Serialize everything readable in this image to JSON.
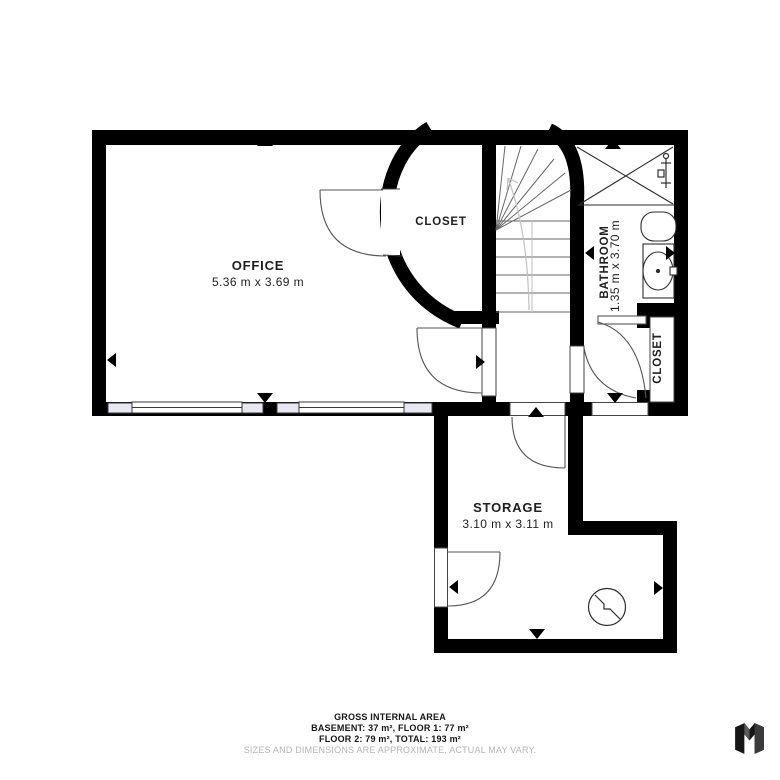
{
  "rooms": {
    "office": {
      "name": "OFFICE",
      "dims": "5.36 m x 3.69 m"
    },
    "closet_top": {
      "name": "CLOSET"
    },
    "bathroom": {
      "name": "BATHROOM",
      "dims": "1.35 m x 3.70 m"
    },
    "closet_right": {
      "name": "CLOSET"
    },
    "storage": {
      "name": "STORAGE",
      "dims": "3.10 m x 3.11 m"
    }
  },
  "footer": {
    "title": "GROSS INTERNAL AREA",
    "areas_line1": "BASEMENT: 37 m², FLOOR 1: 77 m²",
    "areas_line2": "FLOOR 2: 79 m², TOTAL: 193 m²",
    "disclaimer": "SIZES AND DIMENSIONS ARE APPROXIMATE, ACTUAL MAY VARY."
  },
  "colors": {
    "wall": "#000000",
    "window_sill": "#e7e7f2",
    "disclaimer_text": "#b5b5b5",
    "stair_line": "#666666",
    "door_line": "#555555"
  },
  "icons": {
    "logo": "matterport-cube-logo",
    "markers": "camera-direction-triangles"
  }
}
